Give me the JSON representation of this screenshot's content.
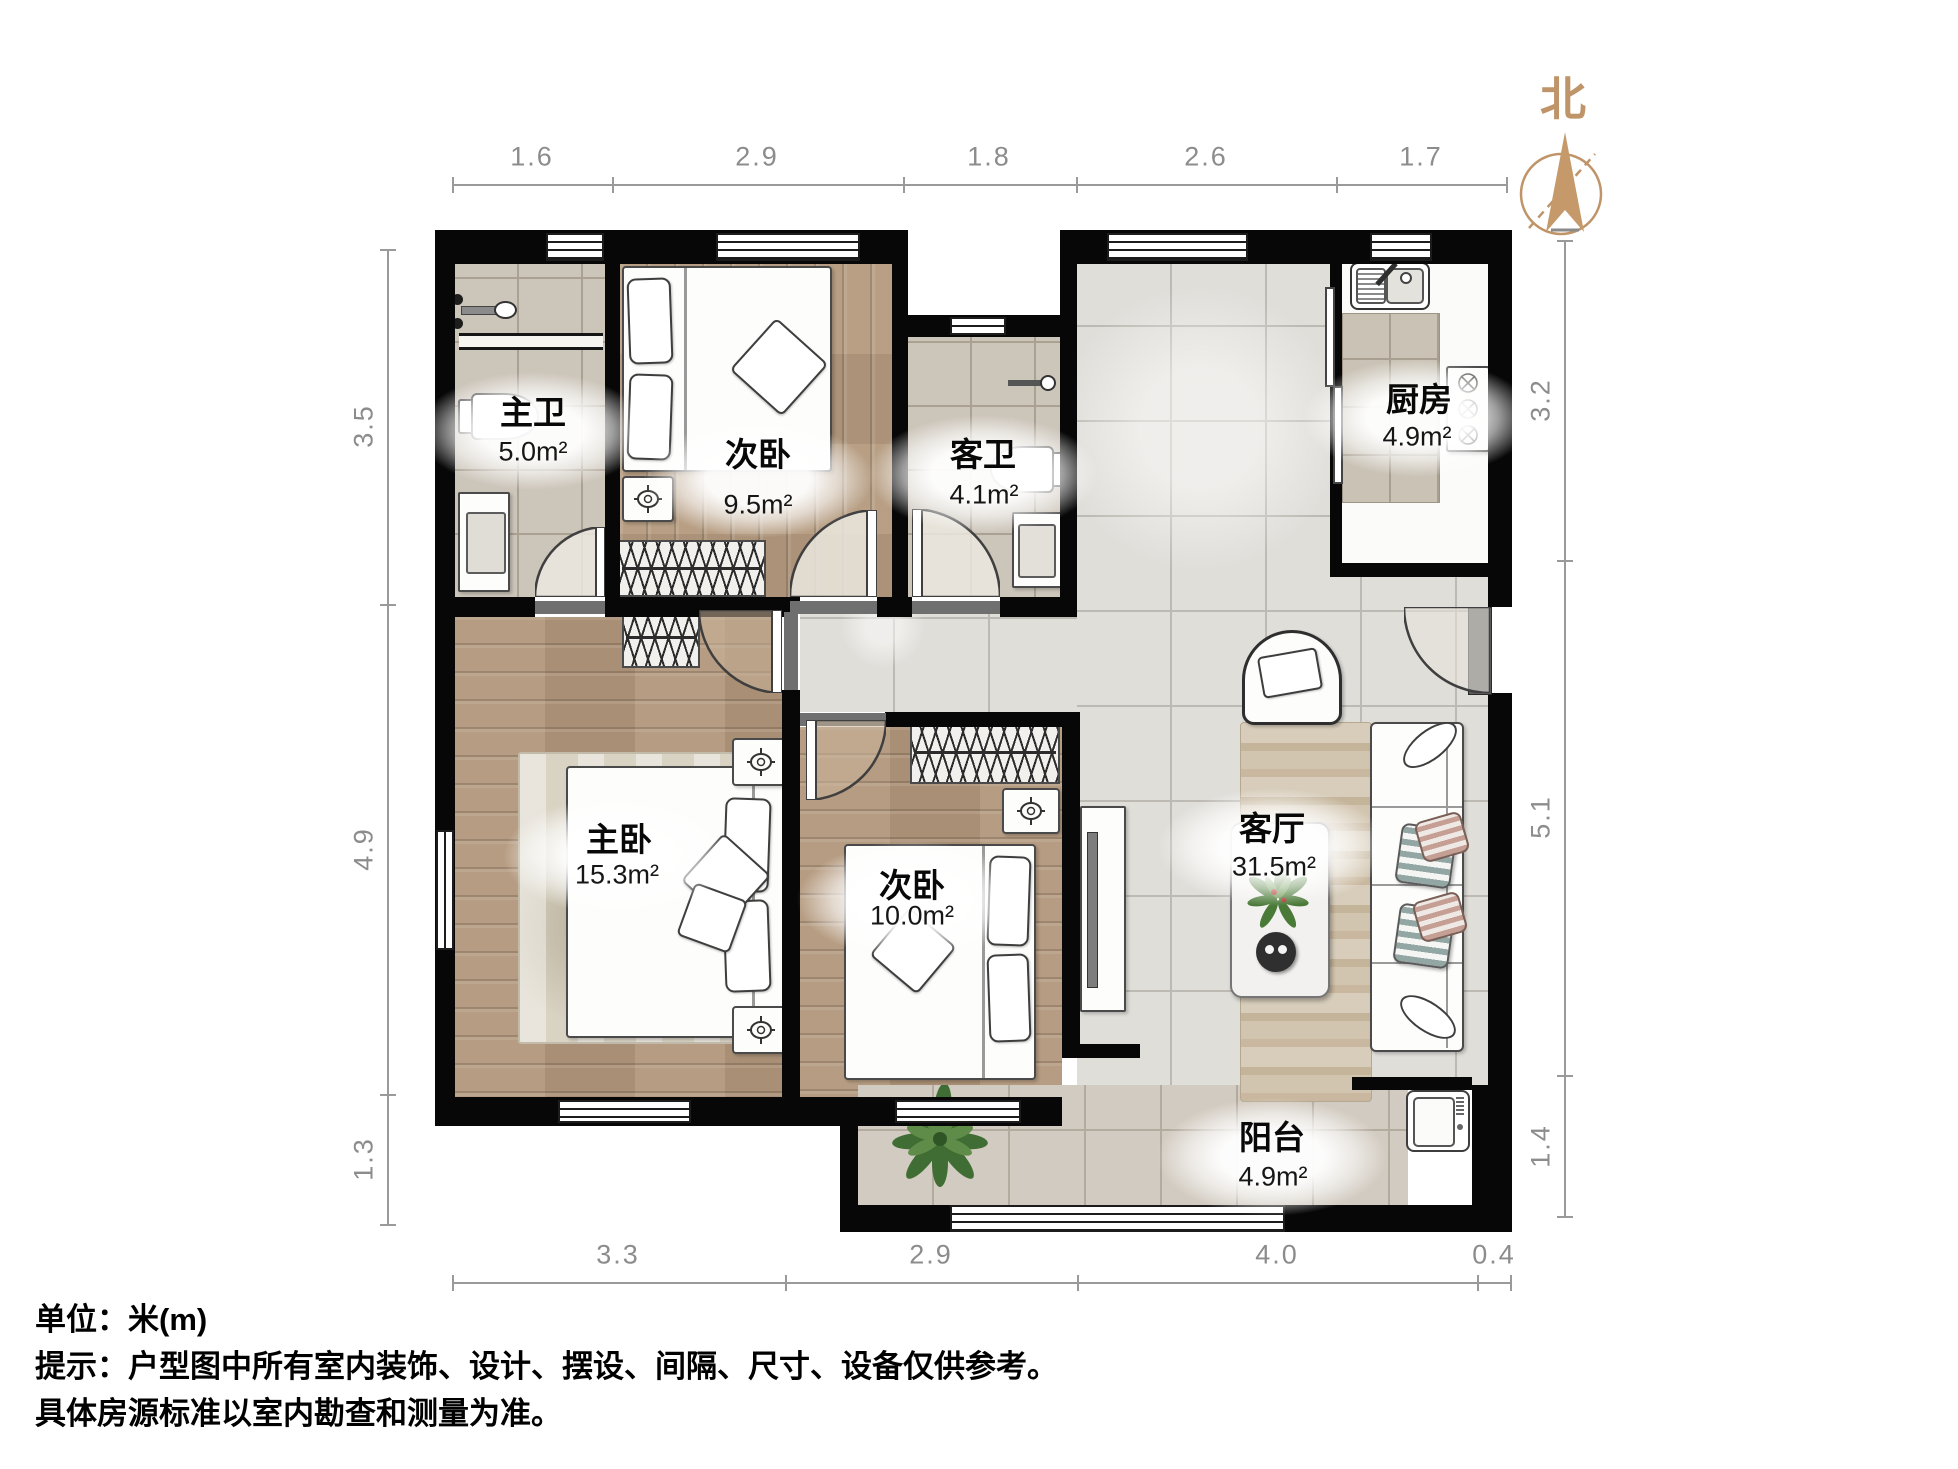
{
  "north": {
    "label": "北"
  },
  "dimensions": {
    "unit": "m",
    "top": [
      "1.6",
      "2.9",
      "1.8",
      "2.6",
      "1.7"
    ],
    "bottom": [
      "3.3",
      "2.9",
      "4.0",
      "0.4"
    ],
    "left": [
      "3.5",
      "4.9",
      "1.3"
    ],
    "right": [
      "3.2",
      "5.1",
      "1.4"
    ]
  },
  "rooms": {
    "master_bath": {
      "name": "主卫",
      "area": "5.0m²"
    },
    "bedroom_top": {
      "name": "次卧",
      "area": "9.5m²"
    },
    "guest_bath": {
      "name": "客卫",
      "area": "4.1m²"
    },
    "kitchen": {
      "name": "厨房",
      "area": "4.9m²"
    },
    "master_bedroom": {
      "name": "主卧",
      "area": "15.3m²"
    },
    "bedroom_bottom": {
      "name": "次卧",
      "area": "10.0m²"
    },
    "living_room": {
      "name": "客厅",
      "area": "31.5m²"
    },
    "balcony": {
      "name": "阳台",
      "area": "4.9m²"
    }
  },
  "notes": {
    "line1": "单位：米(m)",
    "line2": "提示：户型图中所有室内装饰、设计、摆设、间隔、尺寸、设备仅供参考。",
    "line3": "具体房源标准以室内勘查和测量为准。"
  },
  "colors": {
    "wall": "#070707",
    "north_accent": "#bf9468",
    "dim_gray": "#8c8c8c",
    "wood_floor": "#b2977b",
    "tile_floor": "#e0ded9",
    "bath_tile": "#ccc5ba"
  },
  "icons": [
    "north-compass-icon",
    "window-icon",
    "door-arc-icon",
    "bed-icon",
    "pillow-icon",
    "wardrobe-hanger-icon",
    "ceiling-lamp-icon",
    "toilet-icon",
    "sink-vanity-icon",
    "shower-icon",
    "kitchen-sink-icon",
    "stove-icon",
    "sofa-icon",
    "armchair-icon",
    "coffee-table-icon",
    "plant-icon",
    "tv-console-icon",
    "washing-machine-icon",
    "rug-icon"
  ]
}
